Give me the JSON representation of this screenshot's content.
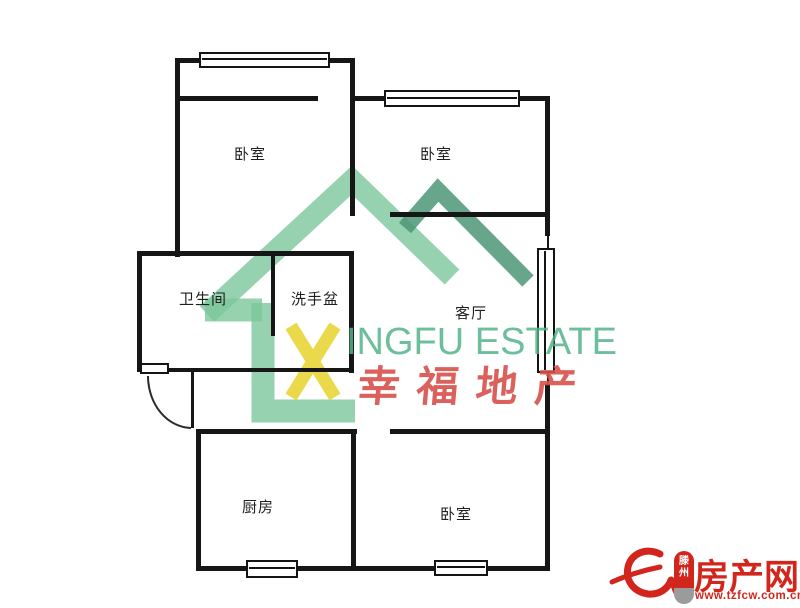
{
  "page": {
    "width": 800,
    "height": 608,
    "background": "#ffffff"
  },
  "floorplan": {
    "wall_color": "#161616",
    "rooms": [
      {
        "id": "bedroom-top-left",
        "label": "卧室",
        "cx": 250,
        "cy": 152
      },
      {
        "id": "bedroom-top-right",
        "label": "卧室",
        "cx": 436,
        "cy": 152
      },
      {
        "id": "bathroom",
        "label": "卫生间",
        "cx": 203,
        "cy": 297
      },
      {
        "id": "washbasin",
        "label": "洗手盆",
        "cx": 315,
        "cy": 297
      },
      {
        "id": "living-room",
        "label": "客厅",
        "cx": 471,
        "cy": 311
      },
      {
        "id": "kitchen",
        "label": "厨房",
        "cx": 258,
        "cy": 505
      },
      {
        "id": "bedroom-bottom",
        "label": "卧室",
        "cx": 456,
        "cy": 512
      }
    ],
    "walls": [
      [
        175,
        58,
        180,
        5
      ],
      [
        175,
        58,
        5,
        199
      ],
      [
        350,
        58,
        5,
        158
      ],
      [
        175,
        96,
        143,
        5
      ],
      [
        353,
        96,
        197,
        5
      ],
      [
        545,
        96,
        5,
        140
      ],
      [
        390,
        212,
        160,
        5
      ],
      [
        547,
        236,
        2,
        13
      ],
      [
        547,
        372,
        2,
        13
      ],
      [
        545,
        384,
        5,
        50
      ],
      [
        390,
        429,
        160,
        5
      ],
      [
        545,
        429,
        5,
        142
      ],
      [
        196,
        566,
        354,
        5
      ],
      [
        196,
        429,
        161,
        5
      ],
      [
        196,
        429,
        5,
        142
      ],
      [
        351,
        429,
        5,
        140
      ],
      [
        137,
        251,
        217,
        5
      ],
      [
        137,
        251,
        5,
        121
      ],
      [
        137,
        368,
        217,
        4
      ],
      [
        271,
        251,
        4,
        85
      ],
      [
        349,
        251,
        5,
        122
      ],
      [
        191,
        372,
        3,
        56
      ]
    ],
    "windows": [
      {
        "x": 199,
        "y": 52,
        "w": 131,
        "h": 16,
        "orient": "h"
      },
      {
        "x": 384,
        "y": 90,
        "w": 136,
        "h": 17,
        "orient": "h"
      },
      {
        "x": 537,
        "y": 248,
        "w": 18,
        "h": 125,
        "orient": "v"
      },
      {
        "x": 434,
        "y": 560,
        "w": 54,
        "h": 16,
        "orient": "h"
      },
      {
        "x": 246,
        "y": 560,
        "w": 52,
        "h": 18,
        "orient": "h"
      }
    ],
    "door": {
      "leaf": [
        140,
        363,
        29,
        11
      ],
      "arc": "M 148 376 A 44 52 0 0 0 191 428"
    }
  },
  "watermark": {
    "brand_x": "X",
    "brand_en": "INGFU ESTATE",
    "brand_cn": "幸福地产",
    "house_color": "#7CC79B",
    "chevron_color": "#4E9678",
    "x_color": "#E9D94B",
    "text_green": "#54B389",
    "text_red": "#D8524B"
  },
  "site_logo": {
    "city_line1": "滕",
    "city_line2": "州",
    "site_name": "房产网",
    "url": "www.tzfcw.com.cn",
    "red": "#D2261C"
  }
}
